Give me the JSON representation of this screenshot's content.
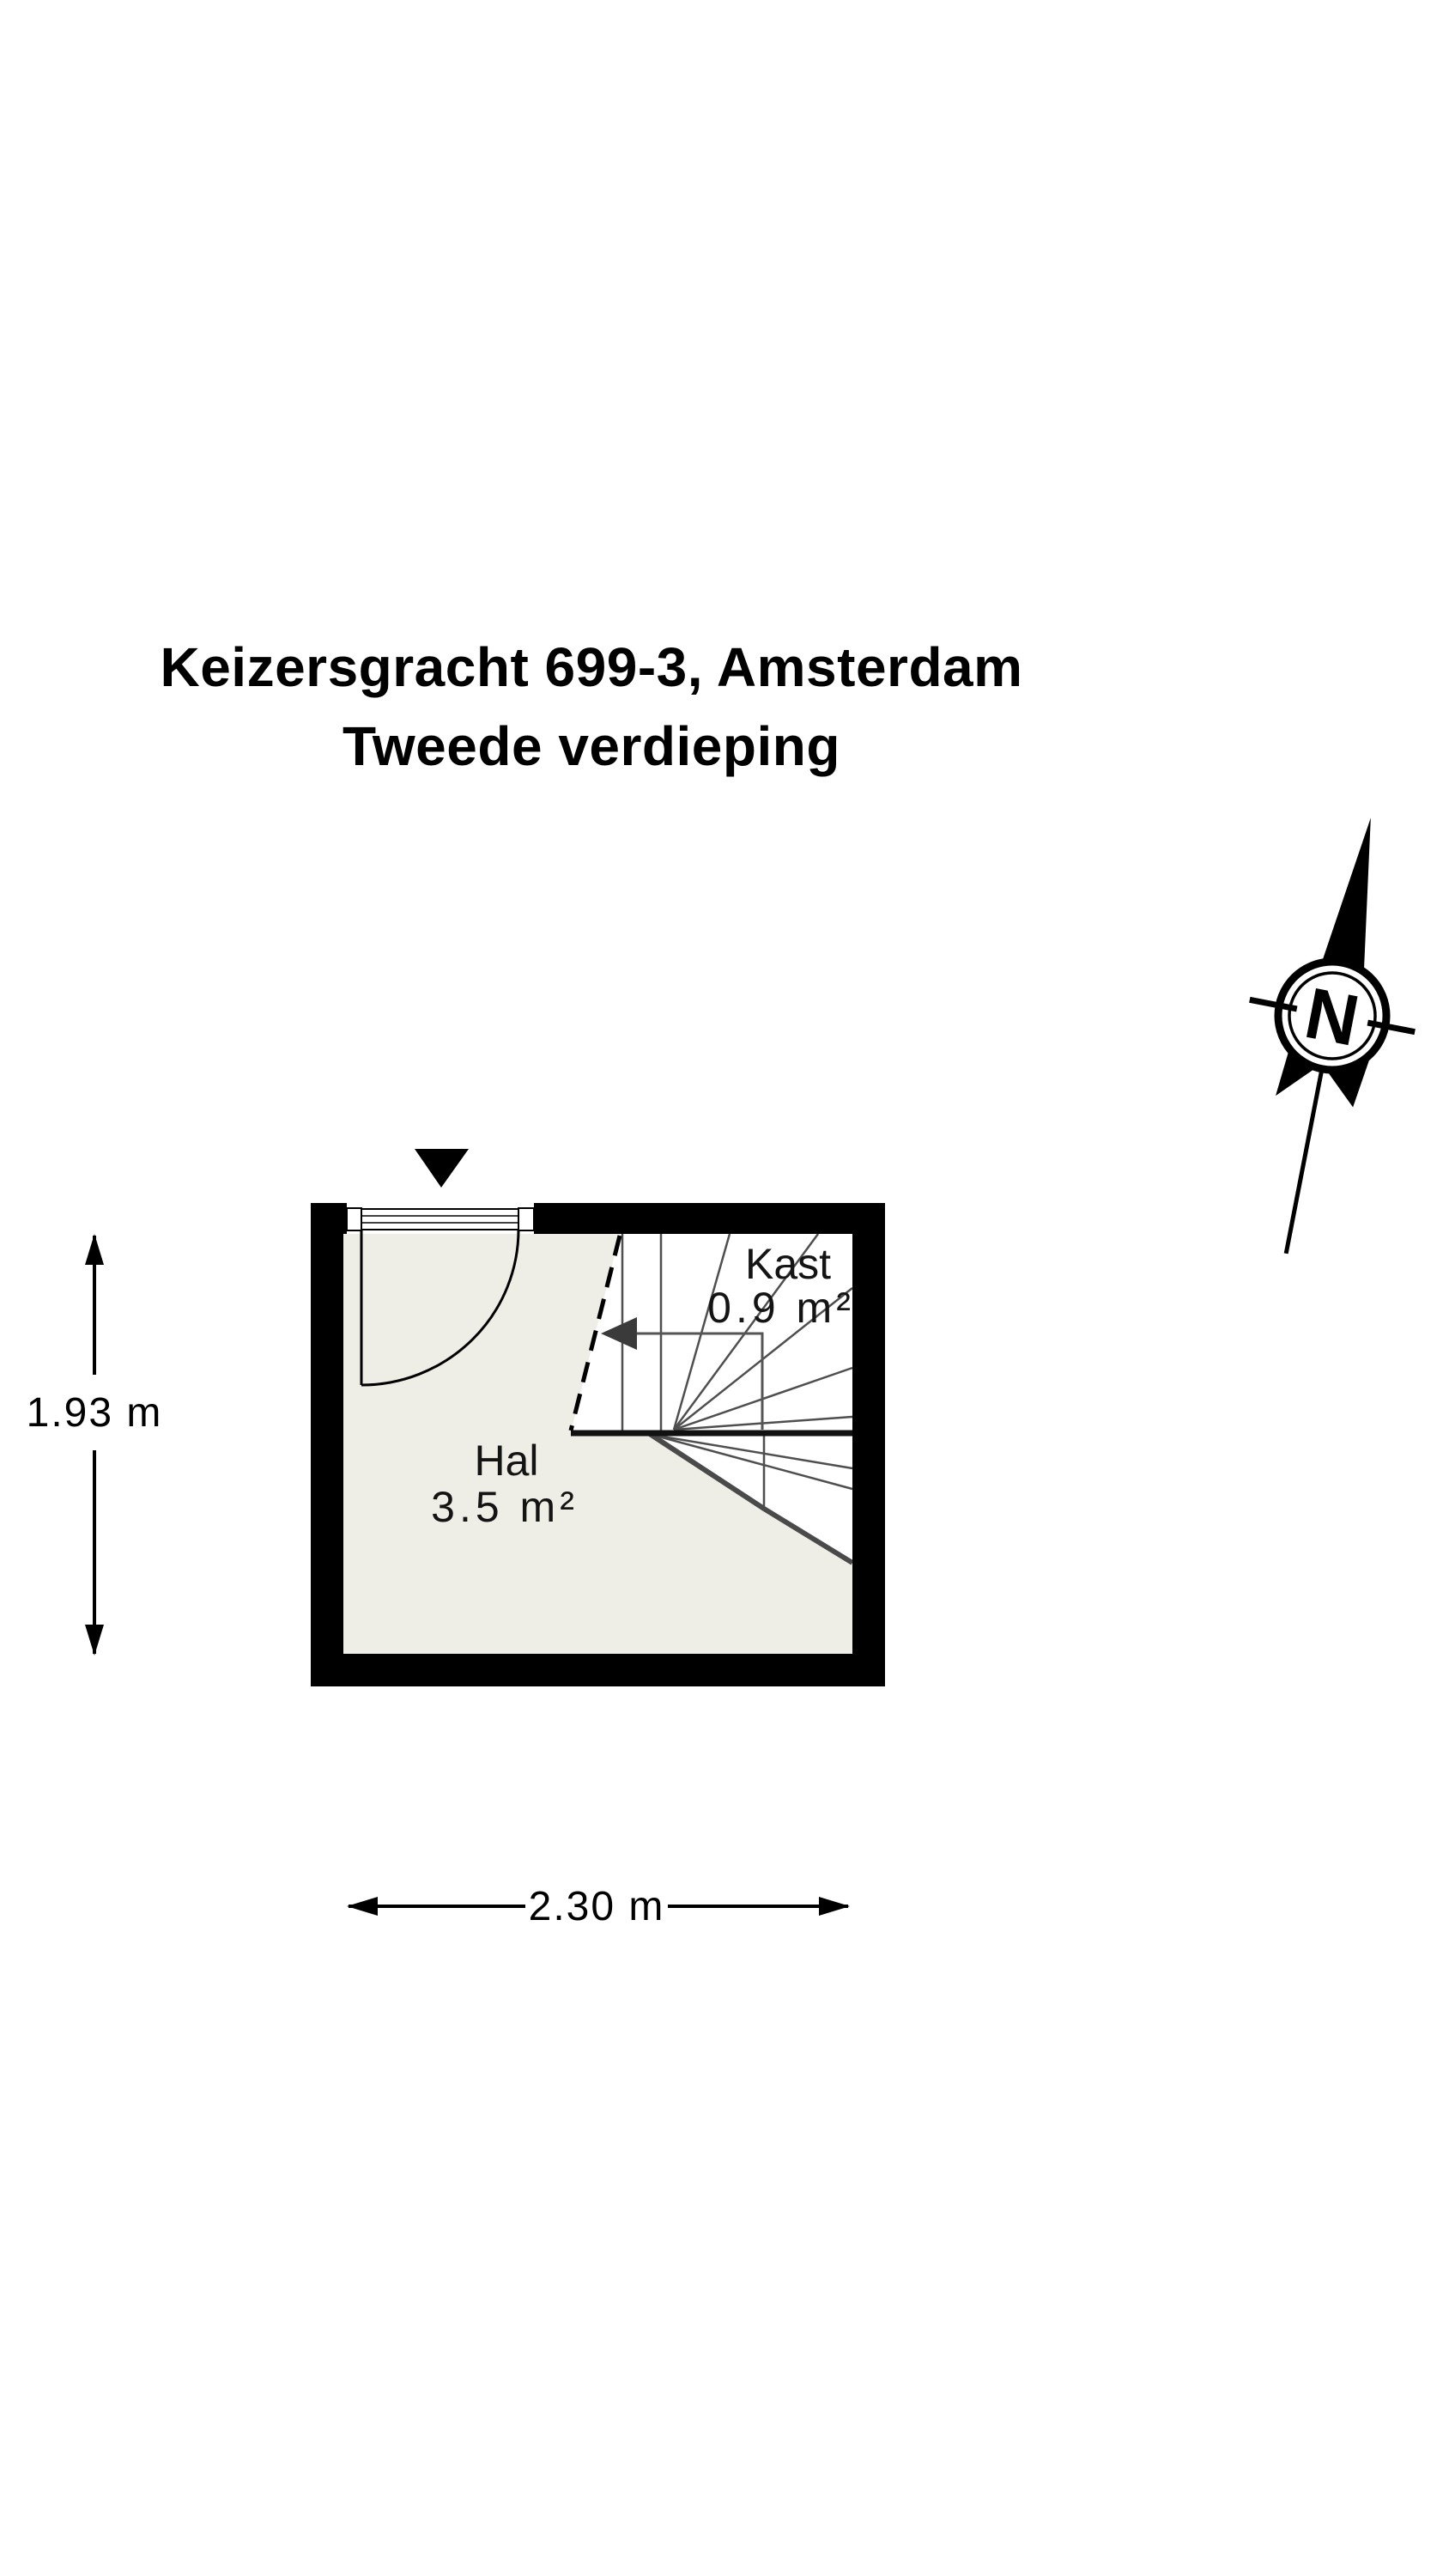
{
  "title": {
    "line1": "Keizersgracht 699-3, Amsterdam",
    "line2": "Tweede verdieping"
  },
  "compass": {
    "north_label": "N"
  },
  "floor_plan": {
    "rooms": [
      {
        "name": "Hal",
        "area": "3.5 m²"
      },
      {
        "name": "Kast",
        "area": "0.9 m²"
      }
    ],
    "dimensions": {
      "depth_label": "1.93 m",
      "width_label": "2.30 m"
    },
    "colors": {
      "wall": "#000000",
      "floor": "#efeee6",
      "stair_line": "#4f4f4f",
      "background": "#ffffff"
    }
  }
}
